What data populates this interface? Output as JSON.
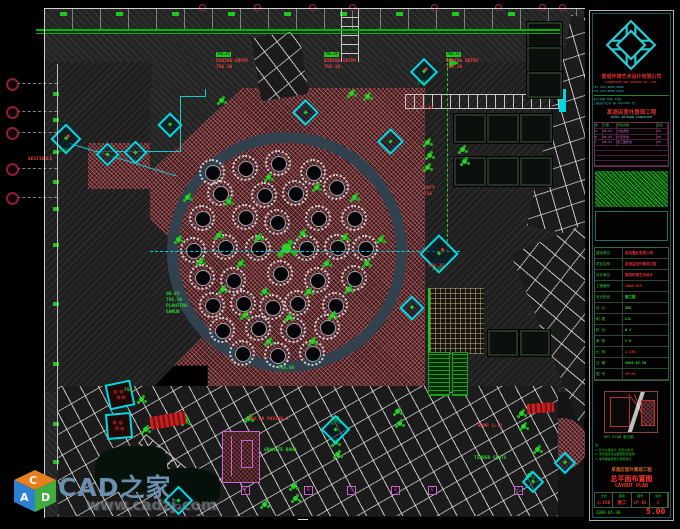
{
  "watermark": {
    "site": "CAD之家",
    "url": "www.cadzj.com",
    "cube": {
      "top_letter": "C",
      "left_letter": "A",
      "right_letter": "D",
      "top_color": "#e6801e",
      "left_color": "#2d7fd3",
      "right_color": "#3fae3f"
    }
  },
  "title_block": {
    "company_cn": "景观环境艺术设计有限公司",
    "company_en": "LANDSCAPE ART DESIGN CO.,LTD.",
    "contact1": "TEL 020-8888 8888",
    "contact2": "FAX 020-8888 6666",
    "cert1": "设计资质 甲级 A1级",
    "cert2": "工程设计证书 第 A123456 号",
    "project_cn": "某酒店室外景观工程",
    "project_en": "HOTEL OUTDOOR LANDSCAPE",
    "rev_headers": [
      "版",
      "日期",
      "修改内容",
      "签名"
    ],
    "rev_rows": [
      [
        "A",
        "08.03",
        "方案调整",
        "ZH"
      ],
      [
        "B",
        "08.04",
        "扩初修改",
        "ZH"
      ],
      [
        "C",
        "08.05",
        "施工图修改",
        "ZH"
      ]
    ],
    "fields": [
      [
        "建设单位",
        "某某置业有限公司",
        "r"
      ],
      [
        "项目名称",
        "某酒店室外景观工程",
        "r"
      ],
      [
        "设计单位",
        "景观环境艺术设计",
        "r"
      ],
      [
        "工程编号",
        "2008-015",
        "r"
      ],
      [
        "设计阶段",
        "施工图",
        "g"
      ],
      [
        "设 计",
        "ZHG",
        "g"
      ],
      [
        "制 图",
        "LYL",
        "g"
      ],
      [
        "校 对",
        "W J",
        "g"
      ],
      [
        "审 核",
        "C H",
        "g"
      ],
      [
        "比 例",
        "1:150",
        "r"
      ],
      [
        "日 期",
        "2008.05.30",
        "g"
      ],
      [
        "图 号",
        "LP-01",
        "r"
      ]
    ],
    "key_plan_label": "KEY PLAN 索引图",
    "notes": [
      "注:",
      "1.尺寸以毫米计 标高以米计",
      "2.须与相关专业图纸配合使用",
      "3.未尽事宜按现行规范执行"
    ],
    "project_line": "某酒店室外景观工程",
    "sheet_title_cn": "总平面布置图",
    "sheet_title_en": "LAYOUT PLAN",
    "bottom_cells": [
      [
        "比例",
        "1:150"
      ],
      [
        "图别",
        "施工"
      ],
      [
        "图号",
        "LP-01"
      ],
      [
        "版次",
        "C"
      ]
    ],
    "date_label": "2008-05-30",
    "rev_big": "5.00"
  },
  "drawing": {
    "circle": {
      "cx": 287,
      "cy": 252,
      "r": 120
    },
    "tables": [
      [
        -75,
        -80
      ],
      [
        -42,
        -84
      ],
      [
        -9,
        -89
      ],
      [
        26,
        -80
      ],
      [
        -67,
        -59
      ],
      [
        -23,
        -57
      ],
      [
        8,
        -59
      ],
      [
        49,
        -65
      ],
      [
        -85,
        -34
      ],
      [
        -42,
        -35
      ],
      [
        -10,
        -30
      ],
      [
        31,
        -34
      ],
      [
        67,
        -34
      ],
      [
        -94,
        -2
      ],
      [
        -62,
        -5
      ],
      [
        -29,
        -4
      ],
      [
        19,
        -4
      ],
      [
        50,
        -5
      ],
      [
        78,
        -4
      ],
      [
        -85,
        25
      ],
      [
        -54,
        28
      ],
      [
        -7,
        21
      ],
      [
        30,
        28
      ],
      [
        67,
        26
      ],
      [
        -75,
        53
      ],
      [
        -44,
        51
      ],
      [
        -15,
        55
      ],
      [
        10,
        51
      ],
      [
        48,
        53
      ],
      [
        -65,
        78
      ],
      [
        -29,
        76
      ],
      [
        6,
        78
      ],
      [
        40,
        75
      ],
      [
        -45,
        101
      ],
      [
        -10,
        103
      ],
      [
        25,
        101
      ]
    ],
    "center_plant": [
      0,
      -3
    ],
    "plants_circle": [
      [
        -99,
        -54
      ],
      [
        -58,
        -50
      ],
      [
        -18,
        -74
      ],
      [
        30,
        -64
      ],
      [
        68,
        -54
      ],
      [
        -108,
        -12
      ],
      [
        -68,
        -16
      ],
      [
        -28,
        -14
      ],
      [
        16,
        -18
      ],
      [
        58,
        -14
      ],
      [
        94,
        -12
      ],
      [
        -86,
        10
      ],
      [
        -46,
        12
      ],
      [
        40,
        12
      ],
      [
        80,
        12
      ],
      [
        -64,
        38
      ],
      [
        -22,
        40
      ],
      [
        22,
        40
      ],
      [
        62,
        38
      ],
      [
        -42,
        64
      ],
      [
        2,
        66
      ],
      [
        46,
        64
      ],
      [
        -18,
        90
      ],
      [
        26,
        90
      ]
    ],
    "plants_page": [
      [
        352,
        94
      ],
      [
        368,
        97
      ],
      [
        222,
        101
      ],
      [
        428,
        143
      ],
      [
        430,
        156
      ],
      [
        428,
        168
      ],
      [
        463,
        150
      ],
      [
        465,
        162
      ],
      [
        186,
        422
      ],
      [
        249,
        419
      ],
      [
        336,
        421
      ],
      [
        398,
        412
      ],
      [
        400,
        424
      ],
      [
        336,
        443
      ],
      [
        338,
        455
      ],
      [
        294,
        487
      ],
      [
        296,
        499
      ],
      [
        522,
        414
      ],
      [
        524,
        427
      ],
      [
        538,
        450
      ],
      [
        142,
        400
      ],
      [
        146,
        430
      ],
      [
        265,
        505
      ],
      [
        530,
        476
      ]
    ],
    "diamonds": [
      {
        "x": 64,
        "y": 137,
        "s": 18,
        "t": "2.50"
      },
      {
        "x": 105,
        "y": 152,
        "s": 13
      },
      {
        "x": 133,
        "y": 150,
        "s": 13
      },
      {
        "x": 168,
        "y": 123,
        "s": 14
      },
      {
        "x": 303,
        "y": 110,
        "s": 15
      },
      {
        "x": 388,
        "y": 139,
        "s": 15
      },
      {
        "x": 422,
        "y": 70,
        "s": 16,
        "t": "1.50"
      },
      {
        "x": 437,
        "y": 252,
        "s": 24,
        "t": "1.50"
      },
      {
        "x": 410,
        "y": 306,
        "s": 14
      },
      {
        "x": 333,
        "y": 427,
        "s": 17
      },
      {
        "x": 176,
        "y": 498,
        "s": 17
      },
      {
        "x": 563,
        "y": 461,
        "s": 12
      },
      {
        "x": 531,
        "y": 480,
        "s": 12
      }
    ],
    "labels": [
      {
        "x": 216,
        "y": 40,
        "ls": [
          [
            "758.15",
            "ch"
          ],
          [
            "DINING ENTRY",
            "r"
          ],
          [
            "756.30",
            "r"
          ]
        ]
      },
      {
        "x": 324,
        "y": 40,
        "ls": [
          [
            "758.15",
            "ch"
          ],
          [
            "DINING ENTRY",
            "r"
          ],
          [
            "756.30",
            "r"
          ]
        ]
      },
      {
        "x": 446,
        "y": 40,
        "ls": [
          [
            "758.15",
            "ch"
          ],
          [
            "DINING ENTRY",
            "r"
          ],
          [
            "756.30",
            "r"
          ]
        ]
      },
      {
        "x": 28,
        "y": 157,
        "ls": [
          [
            "VESTIBULE",
            "r"
          ]
        ]
      },
      {
        "x": 420,
        "y": 106,
        "ls": [
          [
            "P1 A2",
            "r"
          ]
        ]
      },
      {
        "x": 424,
        "y": 186,
        "ls": [
          [
            "DUTY",
            "r"
          ],
          [
            "756",
            "r"
          ]
        ]
      },
      {
        "x": 428,
        "y": 264,
        "ls": [
          [
            "756.35",
            "r"
          ]
        ]
      },
      {
        "x": 248,
        "y": 417,
        "ls": [
          [
            "756.00 PAVING A",
            "r"
          ]
        ]
      },
      {
        "x": 264,
        "y": 448,
        "ls": [
          [
            "GRANITE BAND",
            "g"
          ]
        ]
      },
      {
        "x": 478,
        "y": 424,
        "ls": [
          [
            "RAMP 1:12",
            "r"
          ]
        ]
      },
      {
        "x": 474,
        "y": 456,
        "ls": [
          [
            "TIMBER SEATS",
            "g"
          ]
        ]
      },
      {
        "x": 166,
        "y": 292,
        "ls": [
          [
            "GD-01",
            "g"
          ],
          [
            "756.30",
            "g"
          ],
          [
            "PLANTING",
            "g"
          ],
          [
            "SHRUB",
            "g"
          ]
        ]
      },
      {
        "x": 124,
        "y": 388,
        "ls": [
          [
            "756",
            "g"
          ]
        ]
      },
      {
        "x": 278,
        "y": 366,
        "ls": [
          [
            "758.00",
            "g"
          ]
        ]
      }
    ],
    "keynotes": {
      "y": 486,
      "items": [
        {
          "x": 241,
          "t": "A"
        },
        {
          "x": 304,
          "t": "B"
        },
        {
          "x": 347,
          "t": "C"
        },
        {
          "x": 391,
          "t": "D"
        },
        {
          "x": 428,
          "t": "E"
        },
        {
          "x": 514,
          "t": "F"
        }
      ]
    },
    "grid_bubbles": {
      "bubble_x": 6,
      "line_x": 57,
      "ys": [
        78,
        106,
        127,
        163,
        192
      ],
      "tick_ys": [
        92,
        118,
        150,
        180,
        207,
        243,
        302,
        362,
        422,
        460
      ]
    },
    "red_dots": {
      "y": 4,
      "xs": [
        199,
        254,
        309,
        349,
        431,
        495,
        539,
        559
      ]
    }
  }
}
